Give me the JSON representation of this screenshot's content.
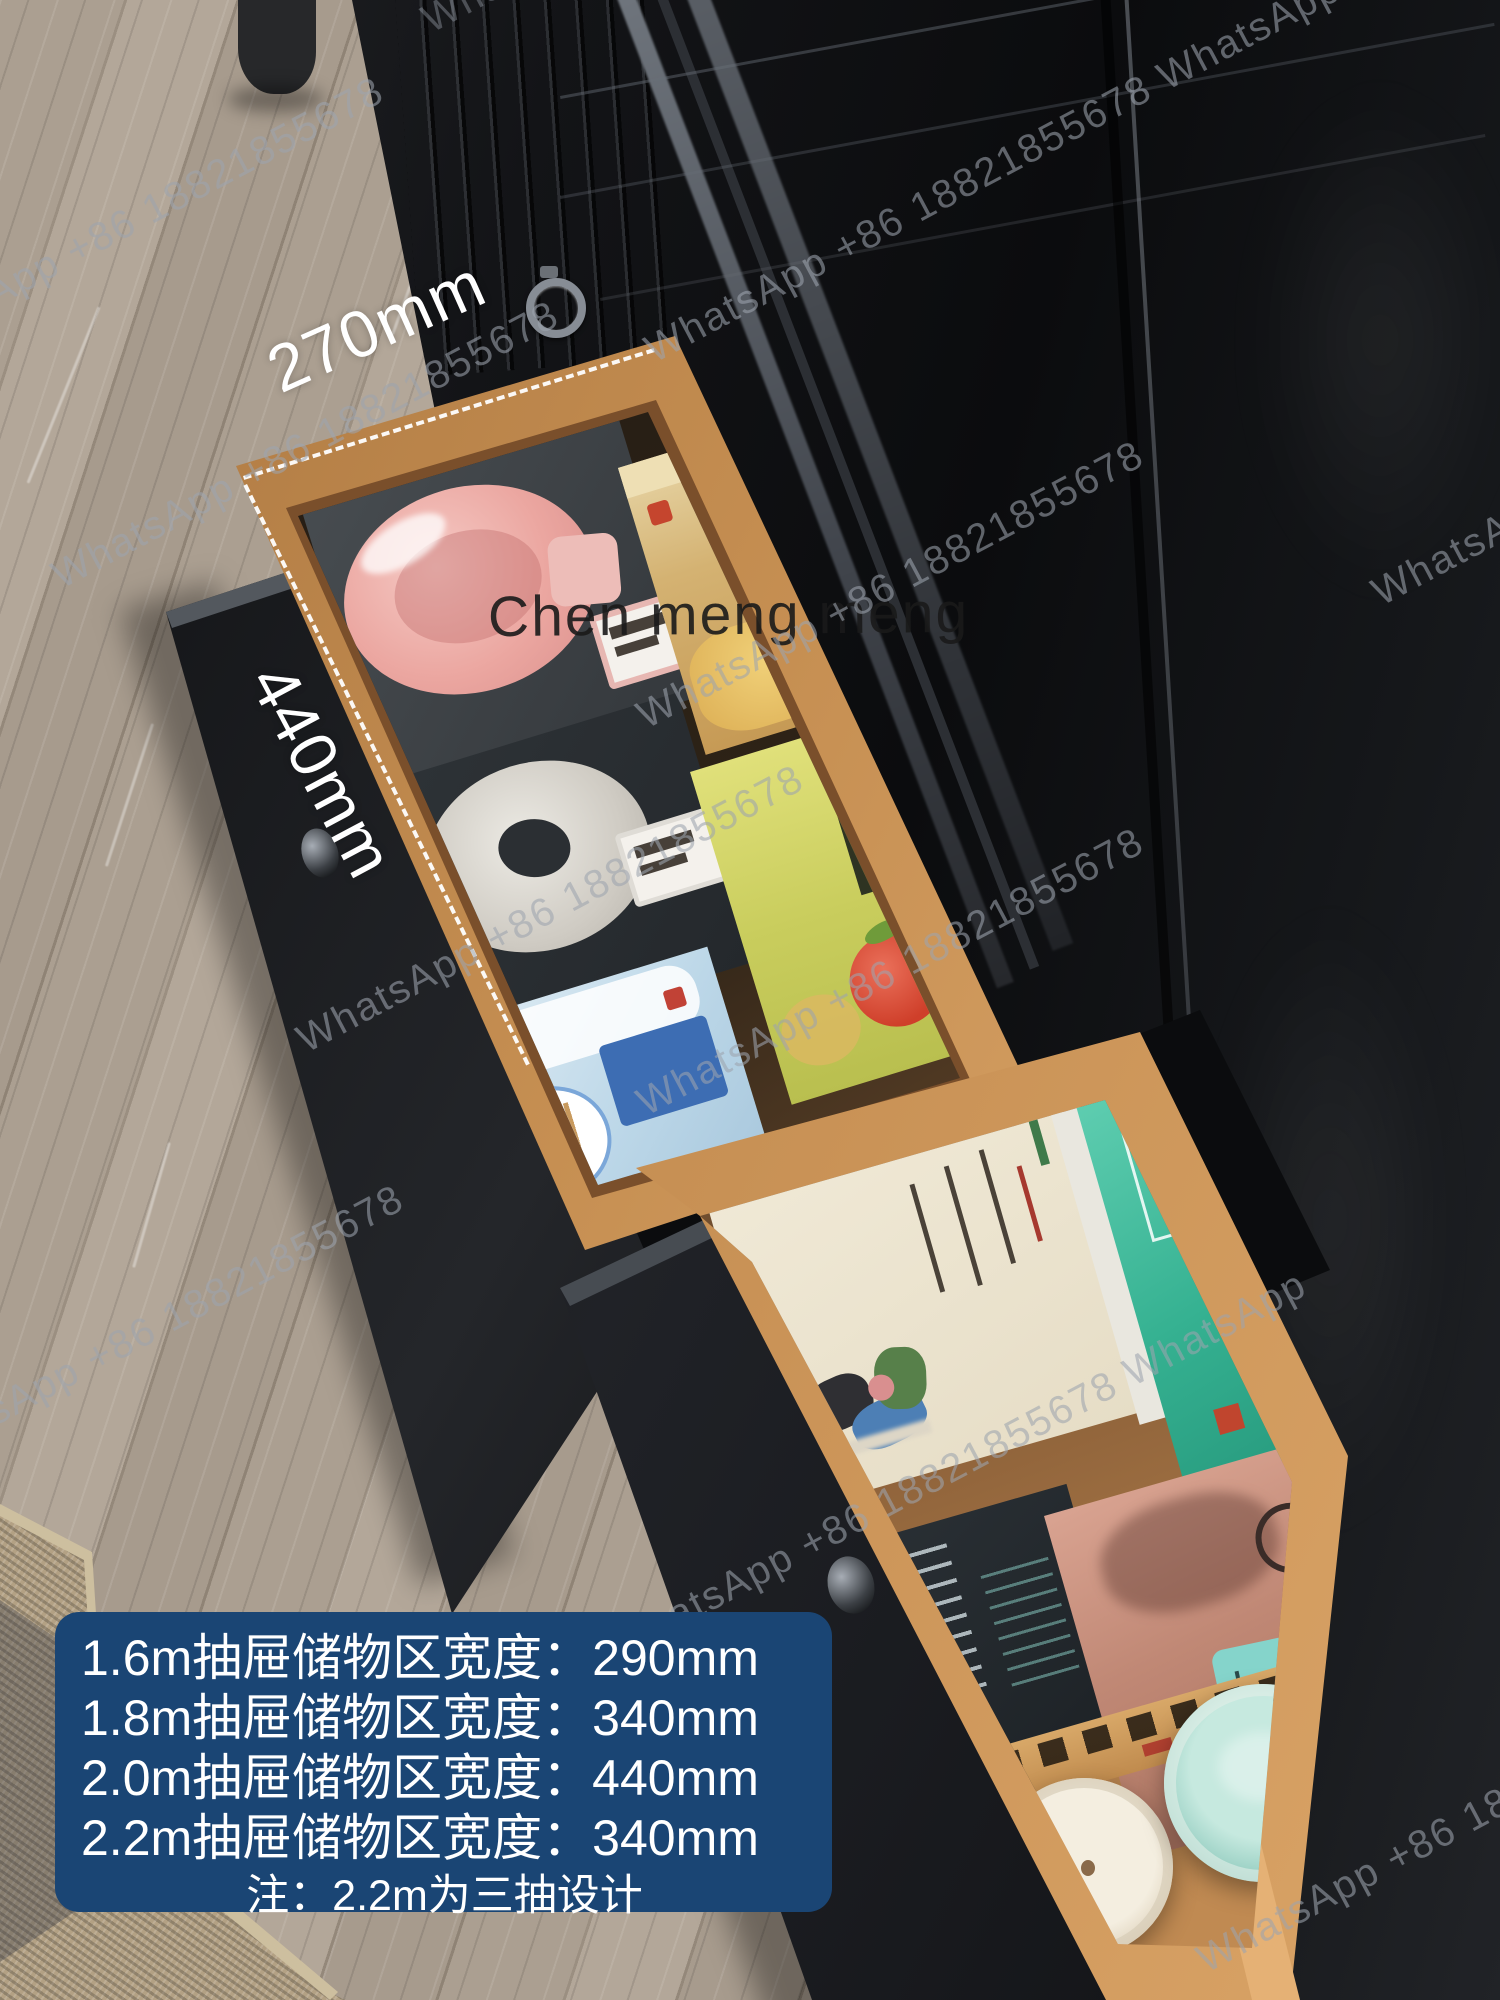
{
  "annotations": {
    "width_label": "270mm",
    "depth_label": "440mm",
    "center_watermark": "Chen meng meng"
  },
  "watermark": {
    "text": "WhatsApp +86 18821855678",
    "text_double": "WhatsApp +86 18821855678 WhatsApp",
    "color": "#9ca4ae"
  },
  "info_box": {
    "bg": "#1a4574",
    "lines": [
      "1.6m抽屉储物区宽度：290mm",
      "1.8m抽屉储物区宽度：340mm",
      "2.0m抽屉储物区宽度：440mm",
      "2.2m抽屉储物区宽度：340mm"
    ],
    "note": "注：2.2m为三抽设计"
  },
  "colors": {
    "dimension_text": "#ffffff",
    "spec_box_bg": "#1a4574",
    "drawer_wood": "#c68f52",
    "cabinet_black": "#101113"
  }
}
